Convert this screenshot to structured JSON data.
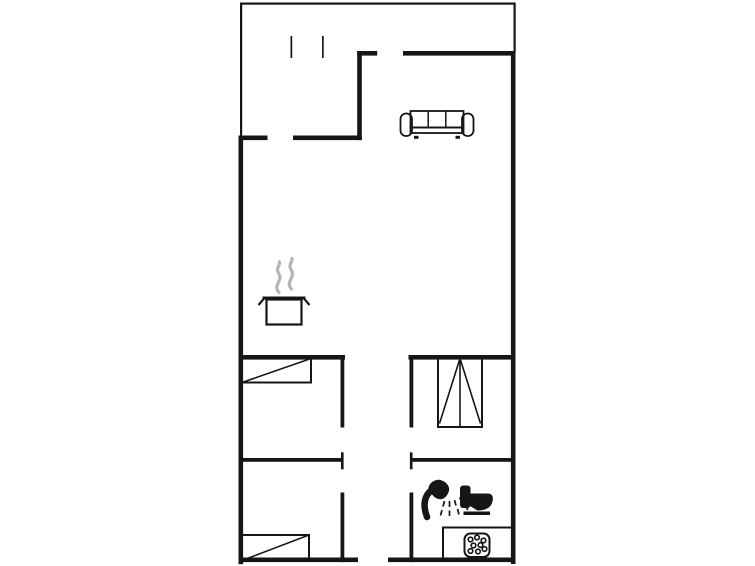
{
  "floor_plan": {
    "canvas": {
      "width": 755,
      "height": 566
    },
    "colors": {
      "line": "#161616",
      "steam": "#b5b5b5",
      "bg": "#ffffff"
    },
    "items": [
      {
        "name": "terrace-walls-thin",
        "interactable": false,
        "shapes": [
          {
            "kind": "rect",
            "x": 240,
            "y": 2.5,
            "w": 275.5,
            "h": 2.2,
            "fill": "line"
          },
          {
            "kind": "rect",
            "x": 240,
            "y": 2.5,
            "w": 2.2,
            "h": 135.5,
            "fill": "line"
          },
          {
            "kind": "rect",
            "x": 513.5,
            "y": 2.5,
            "w": 2.2,
            "h": 50,
            "fill": "line"
          }
        ]
      },
      {
        "name": "terrace-opening-marks",
        "interactable": false,
        "shapes": [
          {
            "kind": "rect",
            "x": 290.5,
            "y": 36,
            "w": 1.7,
            "h": 22,
            "fill": "line"
          },
          {
            "kind": "rect",
            "x": 322,
            "y": 36,
            "w": 1.7,
            "h": 22,
            "fill": "line"
          }
        ]
      },
      {
        "name": "main-walls-thick",
        "interactable": false,
        "shapes": [
          {
            "kind": "rect",
            "x": 238.5,
            "y": 135.5,
            "w": 29,
            "h": 4.6,
            "fill": "line"
          },
          {
            "kind": "rect",
            "x": 293,
            "y": 135.5,
            "w": 68.8,
            "h": 4.6,
            "fill": "line"
          },
          {
            "kind": "rect",
            "x": 357.2,
            "y": 51,
            "w": 4.6,
            "h": 89.1,
            "fill": "line"
          },
          {
            "kind": "rect",
            "x": 357.2,
            "y": 51,
            "w": 20,
            "h": 4.6,
            "fill": "line"
          },
          {
            "kind": "rect",
            "x": 403,
            "y": 51,
            "w": 112.5,
            "h": 4.6,
            "fill": "line"
          },
          {
            "kind": "rect",
            "x": 510.9,
            "y": 51,
            "w": 4.6,
            "h": 513,
            "fill": "line"
          },
          {
            "kind": "rect",
            "x": 238.5,
            "y": 135.5,
            "w": 4.6,
            "h": 428.7,
            "fill": "line"
          },
          {
            "kind": "rect",
            "x": 238.5,
            "y": 557.5,
            "w": 119.5,
            "h": 4.6,
            "fill": "line"
          },
          {
            "kind": "rect",
            "x": 388,
            "y": 557.5,
            "w": 127.5,
            "h": 4.6,
            "fill": "line"
          },
          {
            "kind": "rect",
            "x": 238.5,
            "y": 355,
            "w": 106.5,
            "h": 4.6,
            "fill": "line"
          },
          {
            "kind": "rect",
            "x": 408.5,
            "y": 355,
            "w": 107,
            "h": 4.6,
            "fill": "line"
          },
          {
            "kind": "rect",
            "x": 340.5,
            "y": 355,
            "w": 3.8,
            "h": 72.5,
            "fill": "line"
          },
          {
            "kind": "rect",
            "x": 409.5,
            "y": 355,
            "w": 3.8,
            "h": 72.5,
            "fill": "line"
          },
          {
            "kind": "rect",
            "x": 238.5,
            "y": 458,
            "w": 103.8,
            "h": 3.8,
            "fill": "line"
          },
          {
            "kind": "rect",
            "x": 410,
            "y": 458,
            "w": 105.4,
            "h": 3.8,
            "fill": "line"
          },
          {
            "kind": "rect",
            "x": 340.5,
            "y": 492.5,
            "w": 3.8,
            "h": 69.6,
            "fill": "line"
          },
          {
            "kind": "rect",
            "x": 409.5,
            "y": 492.5,
            "w": 3.8,
            "h": 69.6,
            "fill": "line"
          }
        ]
      },
      {
        "name": "door-jamb-caps",
        "interactable": false,
        "shapes": [
          {
            "kind": "rect",
            "x": 341,
            "y": 452.3,
            "w": 2.6,
            "h": 17,
            "fill": "line"
          },
          {
            "kind": "rect",
            "x": 409.9,
            "y": 452.3,
            "w": 2.6,
            "h": 17,
            "fill": "line"
          }
        ]
      },
      {
        "name": "sofa-icon",
        "interactable": false,
        "shapes": [
          {
            "kind": "rect",
            "x": 410.5,
            "y": 111,
            "w": 53,
            "h": 16.5,
            "stroke": "line",
            "sw": 1.8
          },
          {
            "kind": "line",
            "x1": 428.2,
            "y1": 111,
            "x2": 428.2,
            "y2": 127.5,
            "stroke": "line",
            "sw": 1.5
          },
          {
            "kind": "line",
            "x1": 445.8,
            "y1": 111,
            "x2": 445.8,
            "y2": 127.5,
            "stroke": "line",
            "sw": 1.5
          },
          {
            "kind": "rect",
            "x": 410.5,
            "y": 127.5,
            "w": 53,
            "h": 5.5,
            "stroke": "line",
            "sw": 1.8
          },
          {
            "kind": "rect",
            "x": 400.5,
            "y": 113.5,
            "w": 11.5,
            "h": 22.5,
            "rx": 5.5,
            "stroke": "line",
            "sw": 1.8
          },
          {
            "kind": "rect",
            "x": 462,
            "y": 113.5,
            "w": 11.5,
            "h": 22.5,
            "rx": 5.5,
            "stroke": "line",
            "sw": 1.8
          },
          {
            "kind": "rect",
            "x": 414,
            "y": 135.8,
            "w": 4.5,
            "h": 3,
            "fill": "line"
          },
          {
            "kind": "rect",
            "x": 455.5,
            "y": 135.8,
            "w": 4.5,
            "h": 3,
            "fill": "line"
          }
        ]
      },
      {
        "name": "steam-icon",
        "interactable": false,
        "shapes": [
          {
            "kind": "path",
            "d": "M279,292.5 C272,285 284,281 278.5,273 C275.5,268.5 280,266 279.5,262",
            "stroke": "steam",
            "sw": 3.2,
            "cap": "round",
            "fill": "none"
          },
          {
            "kind": "path",
            "d": "M291.5,289 C284.5,281.5 296.5,277.5 291,269.5 C288,265 292.5,262.5 292,258.5",
            "stroke": "steam",
            "sw": 3.2,
            "cap": "round",
            "fill": "none"
          }
        ]
      },
      {
        "name": "cooking-pot-icon",
        "interactable": false,
        "shapes": [
          {
            "kind": "rect",
            "x": 262.5,
            "y": 296.5,
            "w": 43,
            "h": 3,
            "fill": "line"
          },
          {
            "kind": "rect",
            "x": 266.5,
            "y": 299.5,
            "w": 35,
            "h": 25,
            "stroke": "line",
            "sw": 2.2
          },
          {
            "kind": "line",
            "x1": 258.5,
            "y1": 305,
            "x2": 264,
            "y2": 298.5,
            "stroke": "line",
            "sw": 2.2
          },
          {
            "kind": "line",
            "x1": 304,
            "y1": 298.5,
            "x2": 309.5,
            "y2": 305,
            "stroke": "line",
            "sw": 2.2
          }
        ]
      },
      {
        "name": "bed-icon-top",
        "interactable": false,
        "shapes": [
          {
            "kind": "rect",
            "x": 242,
            "y": 358.5,
            "w": 69,
            "h": 24,
            "stroke": "line",
            "sw": 2
          },
          {
            "kind": "line",
            "x1": 242,
            "y1": 382.5,
            "x2": 311,
            "y2": 358.5,
            "stroke": "line",
            "sw": 1.6
          }
        ]
      },
      {
        "name": "bed-icon-bottom",
        "interactable": false,
        "shapes": [
          {
            "kind": "rect",
            "x": 242,
            "y": 535,
            "w": 67,
            "h": 25.5,
            "stroke": "line",
            "sw": 2
          },
          {
            "kind": "line",
            "x1": 242,
            "y1": 560.5,
            "x2": 309,
            "y2": 535,
            "stroke": "line",
            "sw": 1.6
          }
        ]
      },
      {
        "name": "wardrobe-icon",
        "interactable": false,
        "shapes": [
          {
            "kind": "rect",
            "x": 438,
            "y": 358.5,
            "w": 44,
            "h": 68.5,
            "stroke": "line",
            "sw": 2
          },
          {
            "kind": "line",
            "x1": 460,
            "y1": 358.5,
            "x2": 460,
            "y2": 427,
            "stroke": "line",
            "sw": 1.6
          },
          {
            "kind": "line",
            "x1": 459.5,
            "y1": 360,
            "x2": 439.5,
            "y2": 423.5,
            "stroke": "line",
            "sw": 1.6
          },
          {
            "kind": "line",
            "x1": 460.5,
            "y1": 360,
            "x2": 480.5,
            "y2": 423.5,
            "stroke": "line",
            "sw": 1.6
          }
        ]
      },
      {
        "name": "shower-icon",
        "interactable": false,
        "shapes": [
          {
            "kind": "path",
            "d": "M427,517 C422.5,505 424,494.5 433.5,489",
            "stroke": "line",
            "sw": 6.5,
            "cap": "round",
            "fill": "none"
          },
          {
            "kind": "path",
            "d": "M430.5,483.5 Q437.5,476.5 445.5,482.5 Q452.5,488.5 446,496.5 Q441.5,501.5 435,497.5 L429,491.5 Q427.5,487 430.5,483.5 Z",
            "fill": "line"
          },
          {
            "kind": "line",
            "x1": 444.5,
            "y1": 501,
            "x2": 443,
            "y2": 506.5,
            "stroke": "line",
            "sw": 1.7
          },
          {
            "kind": "line",
            "x1": 442,
            "y1": 510,
            "x2": 440.5,
            "y2": 515.5,
            "stroke": "line",
            "sw": 1.7
          },
          {
            "kind": "line",
            "x1": 449.5,
            "y1": 501,
            "x2": 449.5,
            "y2": 507,
            "stroke": "line",
            "sw": 1.7
          },
          {
            "kind": "line",
            "x1": 449.5,
            "y1": 510.5,
            "x2": 449.5,
            "y2": 516,
            "stroke": "line",
            "sw": 1.7
          },
          {
            "kind": "line",
            "x1": 454.5,
            "y1": 500,
            "x2": 456,
            "y2": 505.5,
            "stroke": "line",
            "sw": 1.7
          },
          {
            "kind": "line",
            "x1": 457.5,
            "y1": 509,
            "x2": 459,
            "y2": 514.5,
            "stroke": "line",
            "sw": 1.7
          },
          {
            "kind": "line",
            "x1": 459.5,
            "y1": 497.5,
            "x2": 462.5,
            "y2": 502,
            "stroke": "line",
            "sw": 1.7
          },
          {
            "kind": "line",
            "x1": 465,
            "y1": 505.5,
            "x2": 468,
            "y2": 510,
            "stroke": "line",
            "sw": 1.7
          },
          {
            "kind": "line",
            "x1": 463,
            "y1": 492.5,
            "x2": 467,
            "y2": 495.5,
            "stroke": "line",
            "sw": 1.7
          }
        ]
      },
      {
        "name": "toilet-icon",
        "interactable": false,
        "shapes": [
          {
            "kind": "rect",
            "x": 460,
            "y": 485.5,
            "w": 10.5,
            "h": 22.5,
            "rx": 3,
            "fill": "line"
          },
          {
            "kind": "path",
            "d": "M470,493.5 L487.5,493.5 Q493.5,493.5 492.8,500 Q491.5,510.5 477.5,510.5 L470,506 Z",
            "fill": "line"
          },
          {
            "kind": "rect",
            "x": 463.5,
            "y": 511.5,
            "w": 26.5,
            "h": 3.5,
            "fill": "line"
          }
        ]
      },
      {
        "name": "kitchen-counter",
        "interactable": false,
        "shapes": [
          {
            "kind": "rect",
            "x": 443,
            "y": 527.5,
            "w": 70,
            "h": 32,
            "stroke": "line",
            "sw": 2
          }
        ]
      },
      {
        "name": "whirlpool-icon",
        "interactable": false,
        "shapes": [
          {
            "kind": "rect",
            "x": 464.5,
            "y": 533.5,
            "w": 25,
            "h": 23.5,
            "rx": 6,
            "stroke": "line",
            "sw": 2
          },
          {
            "kind": "circle",
            "cx": 470.5,
            "cy": 539.5,
            "r": 2.3,
            "stroke": "line",
            "sw": 1.6,
            "fill": "bg"
          },
          {
            "kind": "circle",
            "cx": 477,
            "cy": 537.5,
            "r": 2.3,
            "stroke": "line",
            "sw": 1.6,
            "fill": "bg"
          },
          {
            "kind": "circle",
            "cx": 483.5,
            "cy": 540.5,
            "r": 2.3,
            "stroke": "line",
            "sw": 1.6,
            "fill": "bg"
          },
          {
            "kind": "circle",
            "cx": 473.5,
            "cy": 545.5,
            "r": 2.3,
            "stroke": "line",
            "sw": 1.6,
            "fill": "bg"
          },
          {
            "kind": "circle",
            "cx": 480.5,
            "cy": 545,
            "r": 2.3,
            "stroke": "line",
            "sw": 1.6,
            "fill": "bg"
          },
          {
            "kind": "circle",
            "cx": 470.5,
            "cy": 551,
            "r": 2.3,
            "stroke": "line",
            "sw": 1.6,
            "fill": "bg"
          },
          {
            "kind": "circle",
            "cx": 478,
            "cy": 551.5,
            "r": 2.3,
            "stroke": "line",
            "sw": 1.6,
            "fill": "bg"
          },
          {
            "kind": "circle",
            "cx": 484.5,
            "cy": 549,
            "r": 2.3,
            "stroke": "line",
            "sw": 1.6,
            "fill": "bg"
          }
        ]
      }
    ]
  }
}
